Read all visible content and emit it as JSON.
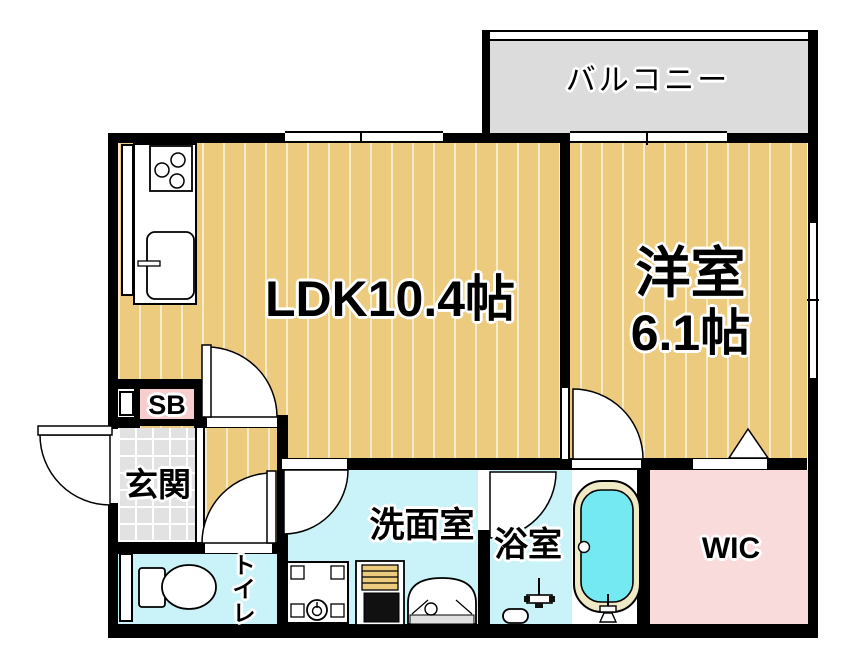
{
  "plan": {
    "balcony_label": "バルコニー",
    "ldk_label": "LDK10.4帖",
    "western_room_label_1": "洋室",
    "western_room_label_2": "6.1帖",
    "shoe_box_label": "SB",
    "entrance_label": "玄関",
    "toilet_chars": [
      "ト",
      "イ",
      "レ"
    ],
    "washroom_label": "洗面室",
    "bathroom_label": "浴室",
    "wic_label": "WIC"
  },
  "colors": {
    "wall": "#000000",
    "floor_tan": "#ecca7e",
    "floor_stripe": "#f6ecc9",
    "balcony_gray": "#dcdcdd",
    "tile_gray": "#e2e2e2",
    "aqua": "#c9f3f8",
    "tub_water": "#74e9f2",
    "tub_rim": "#efe9c6",
    "wic_pink": "#fadbdb",
    "sb_pink": "#f8cdcd"
  }
}
